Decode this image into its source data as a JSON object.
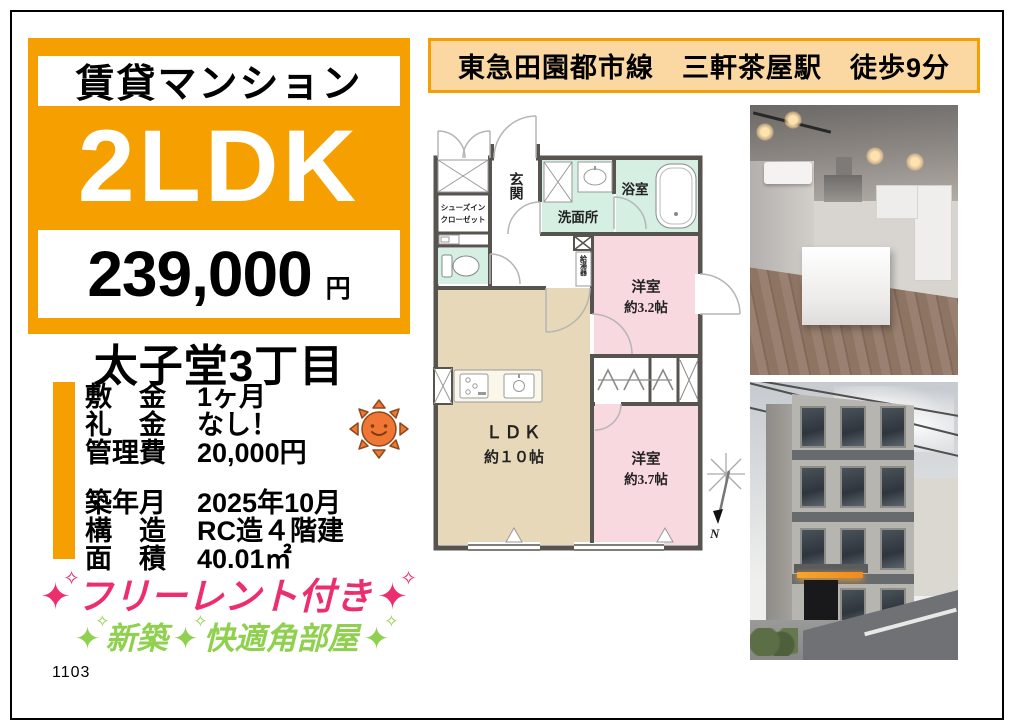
{
  "page": {
    "footer_code": "1103"
  },
  "colors": {
    "accent_orange": "#F5A000",
    "banner_bg": "#FBD7A2",
    "slogan_pink": "#EC2D6E",
    "slogan_green": "#8FD14F",
    "plan_mint": "#D6EFE3",
    "plan_pink": "#F9D9E0",
    "plan_beige": "#E6D8B8"
  },
  "price_box": {
    "category": "賃貸マンション",
    "layout": "2LDK",
    "price": "239,000",
    "unit": "円"
  },
  "address": "太子堂3丁目",
  "station_banner": "東急田園都市線　三軒茶屋駅　徒歩9分",
  "details": {
    "group1": [
      {
        "label": "敷　金",
        "value": "1ヶ月"
      },
      {
        "label": "礼　金",
        "value": "なし！"
      },
      {
        "label": "管理費",
        "value": "20,000円"
      }
    ],
    "group2": [
      {
        "label": "築年月",
        "value": "2025年10月"
      },
      {
        "label": "構　造",
        "value": "RC造４階建"
      },
      {
        "label": "面　積",
        "value": "40.01㎡"
      }
    ]
  },
  "slogans": {
    "line1": "フリーレント付き",
    "line2_part1": "新築",
    "line2_part2": "快適角部屋"
  },
  "icons": {
    "sparkle_big": "✦",
    "sparkle_small": "✧"
  },
  "floor_plan": {
    "entrance": "玄関",
    "shoes1": "シューズイン",
    "shoes2": "クローゼット",
    "washroom": "洗面所",
    "bathroom": "浴室",
    "heater": "給湯器",
    "room1_name": "洋室",
    "room1_size": "約3.2帖",
    "ldk_name": "ＬＤＫ",
    "ldk_size": "約１０帖",
    "room2_name": "洋室",
    "room2_size": "約3.7帖",
    "compass": "N"
  }
}
